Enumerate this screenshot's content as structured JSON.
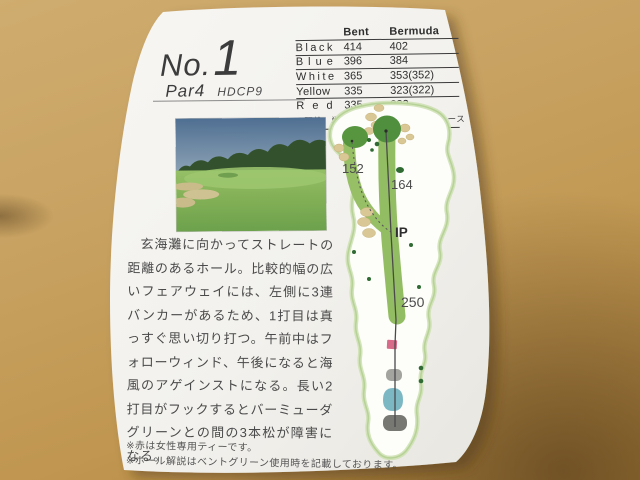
{
  "hole": {
    "no_label": "No.",
    "number": "1",
    "par": "Par4",
    "hdcp": "HDCP9"
  },
  "yardage_table": {
    "headers": [
      "Bent",
      "Bermuda"
    ],
    "rows": [
      {
        "label": "Black",
        "bent": "414",
        "bermuda": "402"
      },
      {
        "label": "Blue",
        "bent": "396",
        "bermuda": "384"
      },
      {
        "label": "White",
        "bent": "365",
        "bermuda": "353(352)"
      },
      {
        "label": "Yellow",
        "bent": "335",
        "bermuda": "323(322)"
      },
      {
        "label": "Red",
        "bent": "335",
        "bermuda": "322"
      }
    ],
    "note": "※距離、単位はヤード（　）はレディース"
  },
  "description": "玄海灘に向かってストレートの距離のあるホール。比較的幅の広いフェアウェイには、左側に3連バンカーがあるため、1打目は真っすぐ思い切り打つ。午前中はフォローウィンド、午後になると海風のアゲインストになる。長い2打目がフックするとバーミューダグリーンとの間の3本松が障害になる。",
  "footnotes": [
    "※赤は女性専用ティーです。",
    "※ホール解説はベントグリーン使用時を記載しております。"
  ],
  "hole_map": {
    "labels": {
      "left_green_yardage": "152",
      "right_tree_yardage": "164",
      "ip": "IP",
      "fairway_yardage": "250"
    }
  },
  "palette": {
    "wood": "#c7a160",
    "paper": "#f3f2ee",
    "fairway_green": "#93bd62",
    "green_dark": "#4f8f3d",
    "bunker_tan": "#d9c795",
    "tee_red": "#d96b8a",
    "tee_blue": "#7cb8c4",
    "tee_gray": "#a3a3a0",
    "tee_black": "#78786f"
  }
}
